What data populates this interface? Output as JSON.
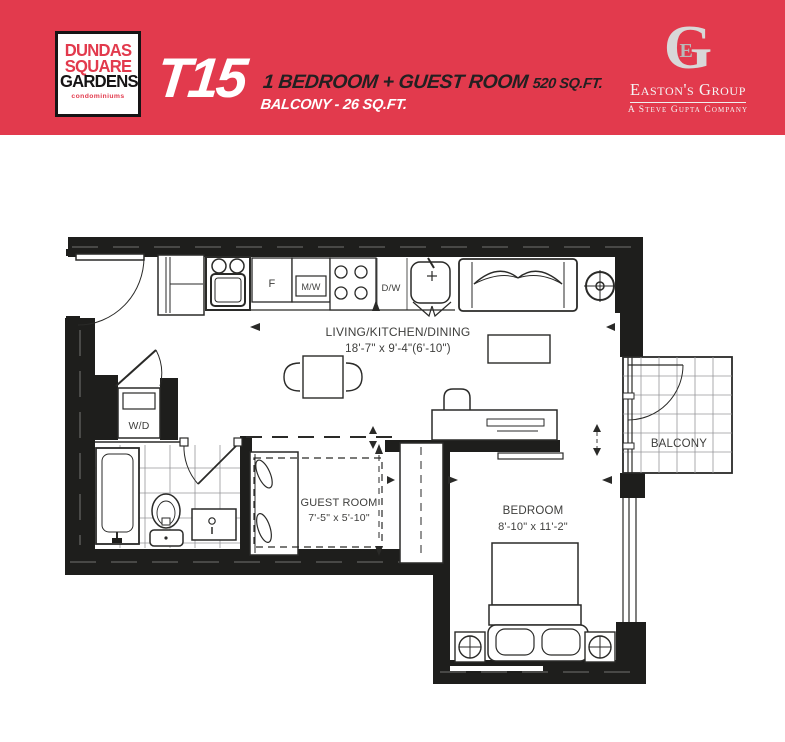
{
  "colors": {
    "accent": "#e23a4d",
    "ink": "#1e1e1c",
    "line": "#2a2a28",
    "label": "#3e3e3c",
    "silver": "#d8d8d8"
  },
  "header": {
    "logo": {
      "line1": "DUNDAS",
      "line2": "SQUARE",
      "line3": "GARDENS",
      "line4": "condominiums"
    },
    "unit_code": "T15",
    "summary_line1": "1 BEDROOM + GUEST ROOM",
    "summary_area": "520 SQ.FT.",
    "summary_line2": "BALCONY - 26 SQ.FT.",
    "brand": {
      "monogram": "G",
      "monogram_inner": "E",
      "name": "Easton's Group",
      "tagline": "A Steve Gupta Company"
    }
  },
  "floorplan": {
    "rooms": {
      "living": {
        "name": "LIVING/KITCHEN/DINING",
        "dims": "18'-7\" x 9'-4\"(6'-10\")"
      },
      "guest": {
        "name": "GUEST ROOM",
        "dims": "7'-5\" x 5'-10\""
      },
      "bedroom": {
        "name": "BEDROOM",
        "dims": "8'-10\" x 11'-2\""
      },
      "balcony": {
        "name": "BALCONY"
      }
    },
    "labels": {
      "fridge": "F",
      "microwave": "M/W",
      "dishwasher": "D/W",
      "washer_dryer": "W/D"
    }
  }
}
